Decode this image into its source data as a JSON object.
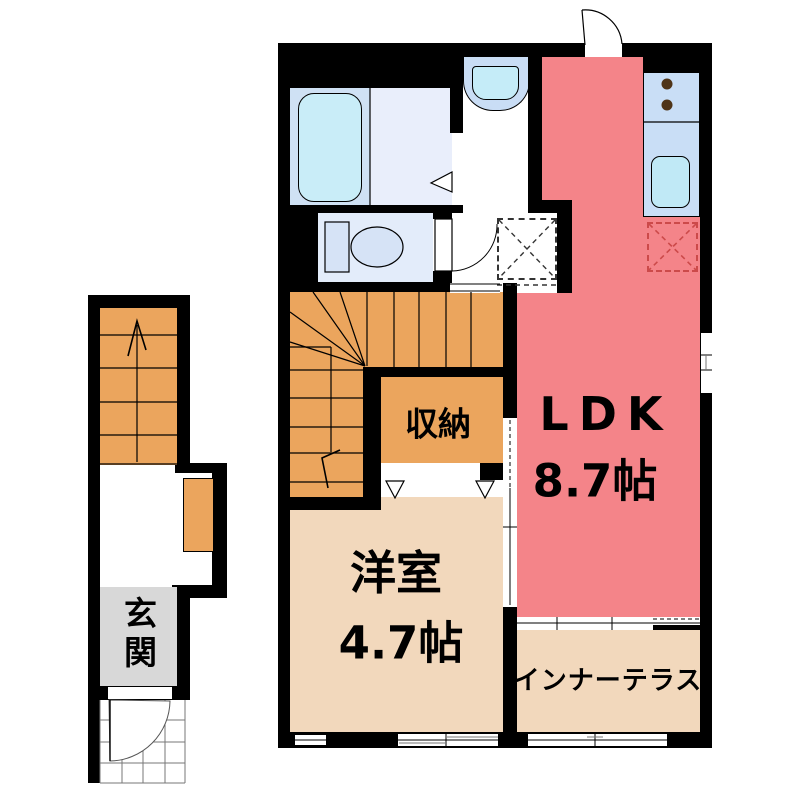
{
  "plan": {
    "rooms": {
      "ldk": {
        "name": "LDK",
        "size": "8.7帖",
        "color": "#f48489"
      },
      "storage": {
        "name": "収納",
        "color": "#eba55d"
      },
      "western": {
        "name": "洋室",
        "size": "4.7帖",
        "color": "#f2d8bc"
      },
      "terrace": {
        "name": "インナーテラス",
        "color": "#f2d8bc"
      },
      "entrance": {
        "name": "玄関",
        "color": "#d8d8d8"
      },
      "bath": {
        "color": "#cfe1f4"
      },
      "washroom": {
        "color": "#e9eefb"
      },
      "toilet": {
        "color": "#e3ecfa"
      },
      "stairs": {
        "color": "#eba55d"
      },
      "hall": {
        "color": "#ffffff"
      }
    },
    "fixtures": {
      "wall_color": "#000000",
      "bathtub_color": "#c9edf8",
      "kitchen_sink_color": "#c0e9f6",
      "counter_color": "#c9def6",
      "washbasin_outer_color": "#c9ddf5",
      "washbasin_bowl_color": "#c5ecf8",
      "toilet_fixture_color": "#d6e3f6",
      "burner_color": "#4f3418",
      "fridge_space_dash_color": "#cc4a4a",
      "washer_space_dash_color": "#333333",
      "tile_line_color": "#777777"
    }
  }
}
